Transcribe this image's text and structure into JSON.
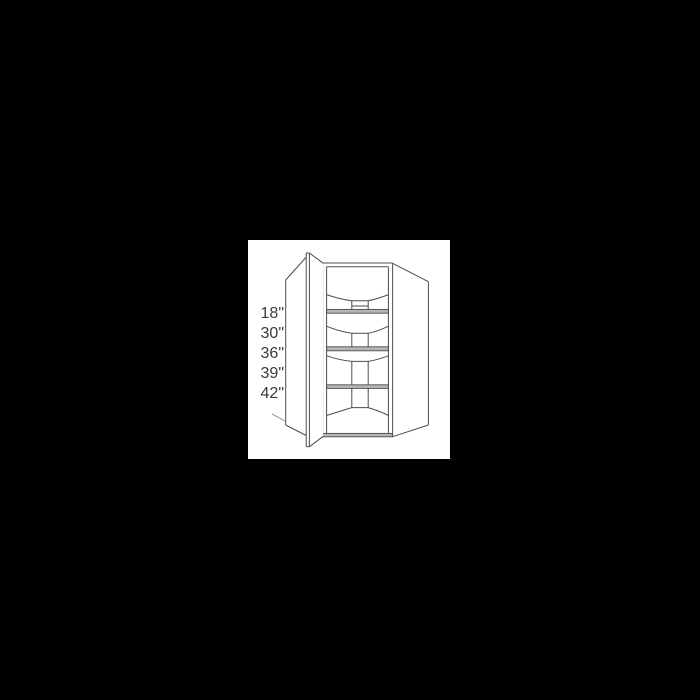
{
  "page": {
    "background_color": "#000000",
    "canvas_background_color": "#ffffff"
  },
  "diagram": {
    "subject": "diagonal-corner-wall-cabinet-open-door-line-drawing",
    "line_color": "#4d4d4d",
    "shelf_band_color": "#b5b5b5",
    "label_text_color": "#3b3b3b",
    "shelf_count": 3,
    "dimension_labels": [
      "18\"",
      "30\"",
      "36\"",
      "39\"",
      "42\""
    ]
  }
}
